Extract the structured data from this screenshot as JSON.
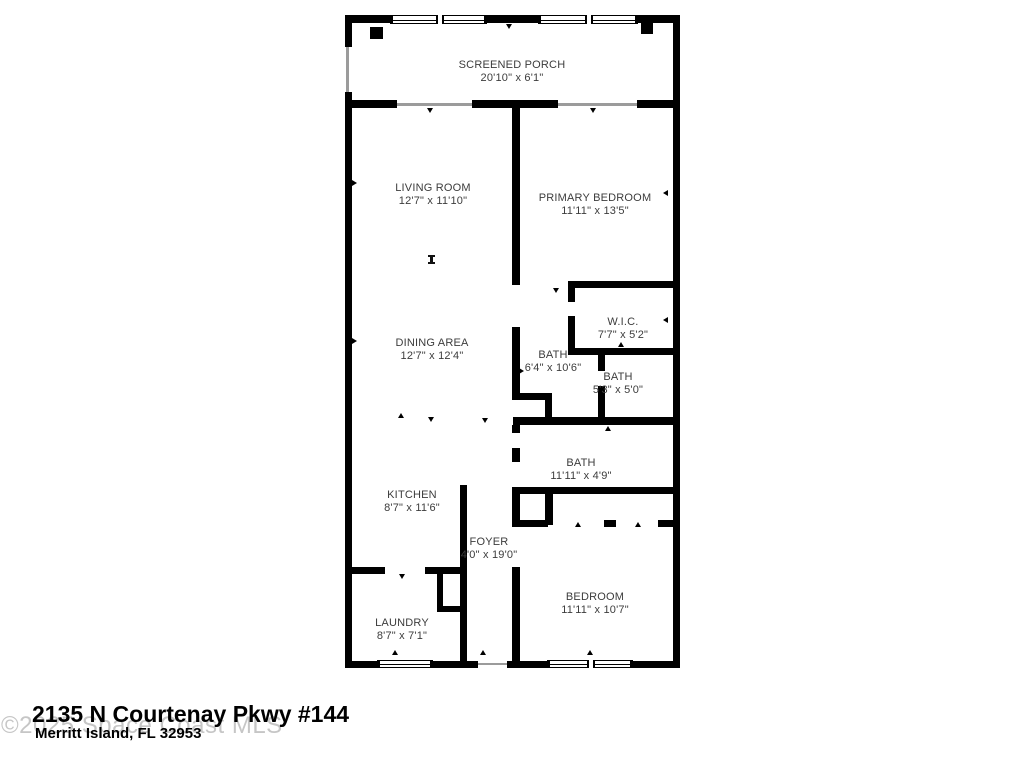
{
  "floorplan": {
    "rooms": [
      {
        "name": "SCREENED PORCH",
        "dims": "20'10\" x 6'1\""
      },
      {
        "name": "LIVING ROOM",
        "dims": "12'7\" x 11'10\""
      },
      {
        "name": "PRIMARY BEDROOM",
        "dims": "11'11\" x 13'5\""
      },
      {
        "name": "DINING AREA",
        "dims": "12'7\" x 12'4\""
      },
      {
        "name": "W.I.C.",
        "dims": "7'7\" x 5'2\""
      },
      {
        "name": "BATH",
        "dims": "6'4\" x 10'6\""
      },
      {
        "name": "BATH",
        "dims": "5'3\" x 5'0\""
      },
      {
        "name": "BATH",
        "dims": "11'11\" x 4'9\""
      },
      {
        "name": "KITCHEN",
        "dims": "8'7\" x 11'6\""
      },
      {
        "name": "FOYER",
        "dims": "4'0\" x 19'0\""
      },
      {
        "name": "LAUNDRY",
        "dims": "8'7\" x 7'1\""
      },
      {
        "name": "BEDROOM",
        "dims": "11'11\" x 10'7\""
      }
    ]
  },
  "footer": {
    "address_line1": "2135 N Courtenay Pkwy #144",
    "address_line2": "Merritt Island, FL 32953",
    "watermark": "©2025 Space Coast MLS"
  },
  "colors": {
    "wall": "#000000",
    "label_text": "#3c3c3c",
    "watermark": "#c6c6c6"
  }
}
